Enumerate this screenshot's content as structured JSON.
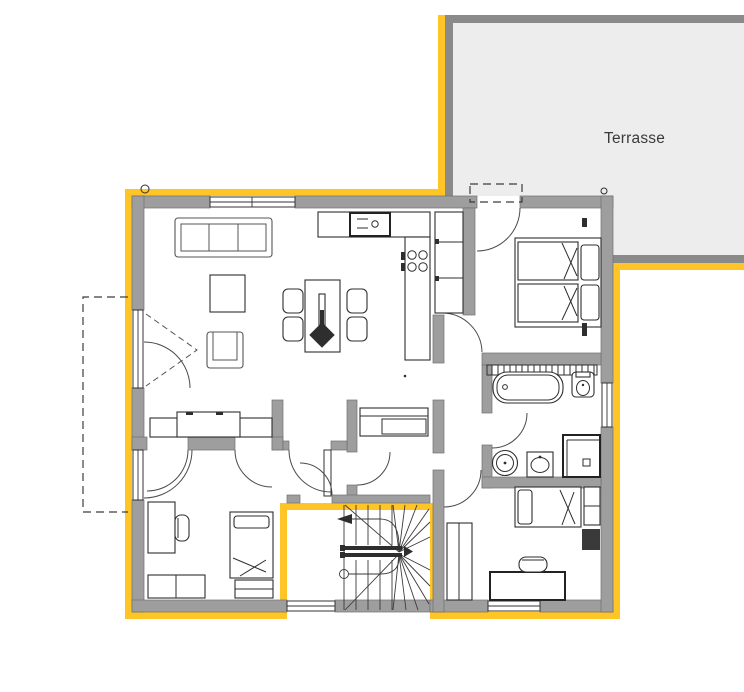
{
  "page": {
    "background": "#FFFFFF"
  },
  "terrace": {
    "label": "Terrasse"
  },
  "colors": {
    "accent": "#FFC425",
    "wall": "#9E9E9E",
    "terrace_fill": "#EDEDED",
    "terrace_border": "#8A8A8A",
    "ink": "#2E2E2E",
    "label_ink": "#3A3A3A",
    "paper": "#FFFFFF"
  }
}
